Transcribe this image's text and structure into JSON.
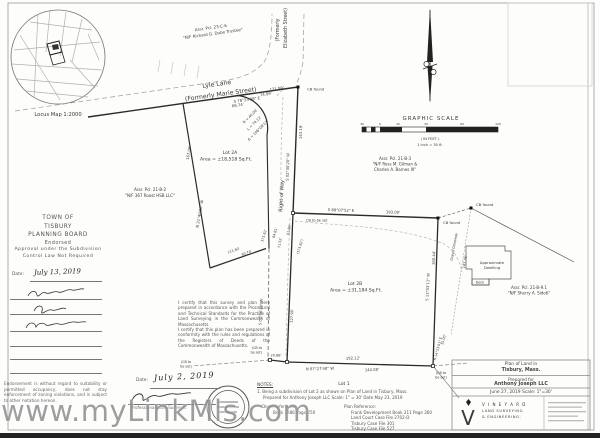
{
  "watermark": "www.myLinkMls.com",
  "locus": {
    "label": "Locus Map   1:2000"
  },
  "scale_bar": {
    "title": "GRAPHIC SCALE",
    "ticks": [
      "30",
      "0",
      "15",
      "30",
      "60",
      "120"
    ],
    "unit_note": "( IN FEET )",
    "ratio_note": "1 inch = 30  ft."
  },
  "streets": {
    "lyle1": "Lyle Lane",
    "lyle2": "(Formerly Marie Street)",
    "eliz1": "(Formerly",
    "eliz2": "Elizabeth Street)",
    "row": "Right of Way",
    "driveway": "Gravel Driveway"
  },
  "neighbors": {
    "dube1": "Assr. Pcl. 23-C-6",
    "dube2": "\"N/F Richard G. Dube Trustee\"",
    "roost1": "Assr. Pcl. 21-B-2",
    "roost2": "\"N/F 367 Roost HSB LLC\"",
    "gilman1": "Assr. Pcl. 21-B-3",
    "gilman2": "\"N/F Ross M. Gilman &",
    "gilman3": "Charles A. Barnes III\"",
    "sidoti1": "Assr. Pcl. 21-B-9.1",
    "sidoti2": "\"N/F Sherry A. Sidoti\""
  },
  "lots": {
    "lot2a_name": "Lot 2A",
    "lot2a_area": "Area = ±18,518 Sq.Ft.",
    "lot2b_name": "Lot 2B",
    "lot2b_area": "Area = ±31,184 Sq.Ft.",
    "lot1": "Lot 1"
  },
  "dims": {
    "lyle_bearing": "S 78°33'08\" E",
    "lyle_d1": "66.74'",
    "lyle_d2": "121.99'",
    "lyle_d3": "74.99'",
    "curve_r": "R = 40.00'",
    "curve_l": "L = 74.12'",
    "curve_delta": "Δ = 106°08'13\"",
    "row_e_bearing": "S 02°40'20\" W",
    "row_e_dim": "143.19'",
    "west_bearing": "N 21°40'50\" W",
    "west_dim": "167.06'",
    "n193_bearing": "S 88°07'52\" E",
    "n193_dim": "193.00'",
    "j1": "64.81'",
    "j2": "61.99'",
    "j3": "71.52'",
    "j4": "171.82'",
    "j5": "(171.82')",
    "j6": "60.76'",
    "j7": "111.60'",
    "row_s_bearing": "S 02°06'20\" W",
    "row_s_dim": "127.96'",
    "south_bearing": "N 87°27'48\" W",
    "south_dim": "192.12'",
    "south_dim2": "142.88'",
    "south_jog": "20.88'",
    "se_bearing": "N 14°23'01\" E",
    "se_dim": "15.00'",
    "east_bearing": "S 13°03'11\" W",
    "east_dim": "160.44'",
    "fence_dim": "147.76'"
  },
  "markers": {
    "cb_found": "CB found",
    "cb_set": "CB to be set",
    "cb_set_p1": "(CB to",
    "cb_set_p2": "be set)"
  },
  "dwelling": {
    "l1": "Approximate",
    "l2": "Dwelling",
    "deck": "Deck"
  },
  "board": {
    "l1": "TOWN OF",
    "l2": "TISBURY",
    "l3": "PLANNING BOARD",
    "l4": "Endorsed",
    "l5": "Approval under the Subdivision",
    "l6": "Control Law Not Required",
    "date_label": "Date:",
    "date_value": "July 13, 2019",
    "endorsement": "Endorsement is without regard to suitability or permitted occupancy, does not stay enforcement of zoning violations, and is subject to other notation hereon."
  },
  "cert": {
    "p1": "I certify that this survey and plan were prepared in accordance with the Procedural and Technical Standards for the Practice of Land Surveying in the Commonwealth of Massachusetts.",
    "p2": "I certify that this plan has been prepared in conformity with the rules and regulations of the Registers of Deeds of the Commonwealth of Massachusetts.",
    "date_label": "Date:",
    "date_value": "July 2, 2019",
    "surveyor": "Professional Land Surveyor"
  },
  "notes": {
    "heading": "NOTES:",
    "n1": "1. Being a subdivision of Lot 2 as shown on Plan of Land in Tisbury, Mass.",
    "n2": "Prepared for Anthony Joseph LLC   Scale: 1\" = 30'   Date May 23, 2019",
    "deed_label": "Deed Reference:",
    "deed": "Book 1486 Page 250",
    "plan_label": "Plan Reference:",
    "p1": "Frank Development Book 211 Page 260",
    "p2": "Land Court Case File 2702-D",
    "p3": "Tisbury Case File 301",
    "p4": "Tisbury Case File 527"
  },
  "title_block": {
    "l1": "Plan of Land in",
    "l2": "Tisbury, Mass.",
    "l3": "Prepared for",
    "l4": "Anthony Joseph LLC",
    "l5": "June 27, 2019    Scale: 1\"=30'",
    "company1": "V I N E Y A R D",
    "company2": "LAND SURVEYING",
    "company3": "& ENGINEERING."
  }
}
